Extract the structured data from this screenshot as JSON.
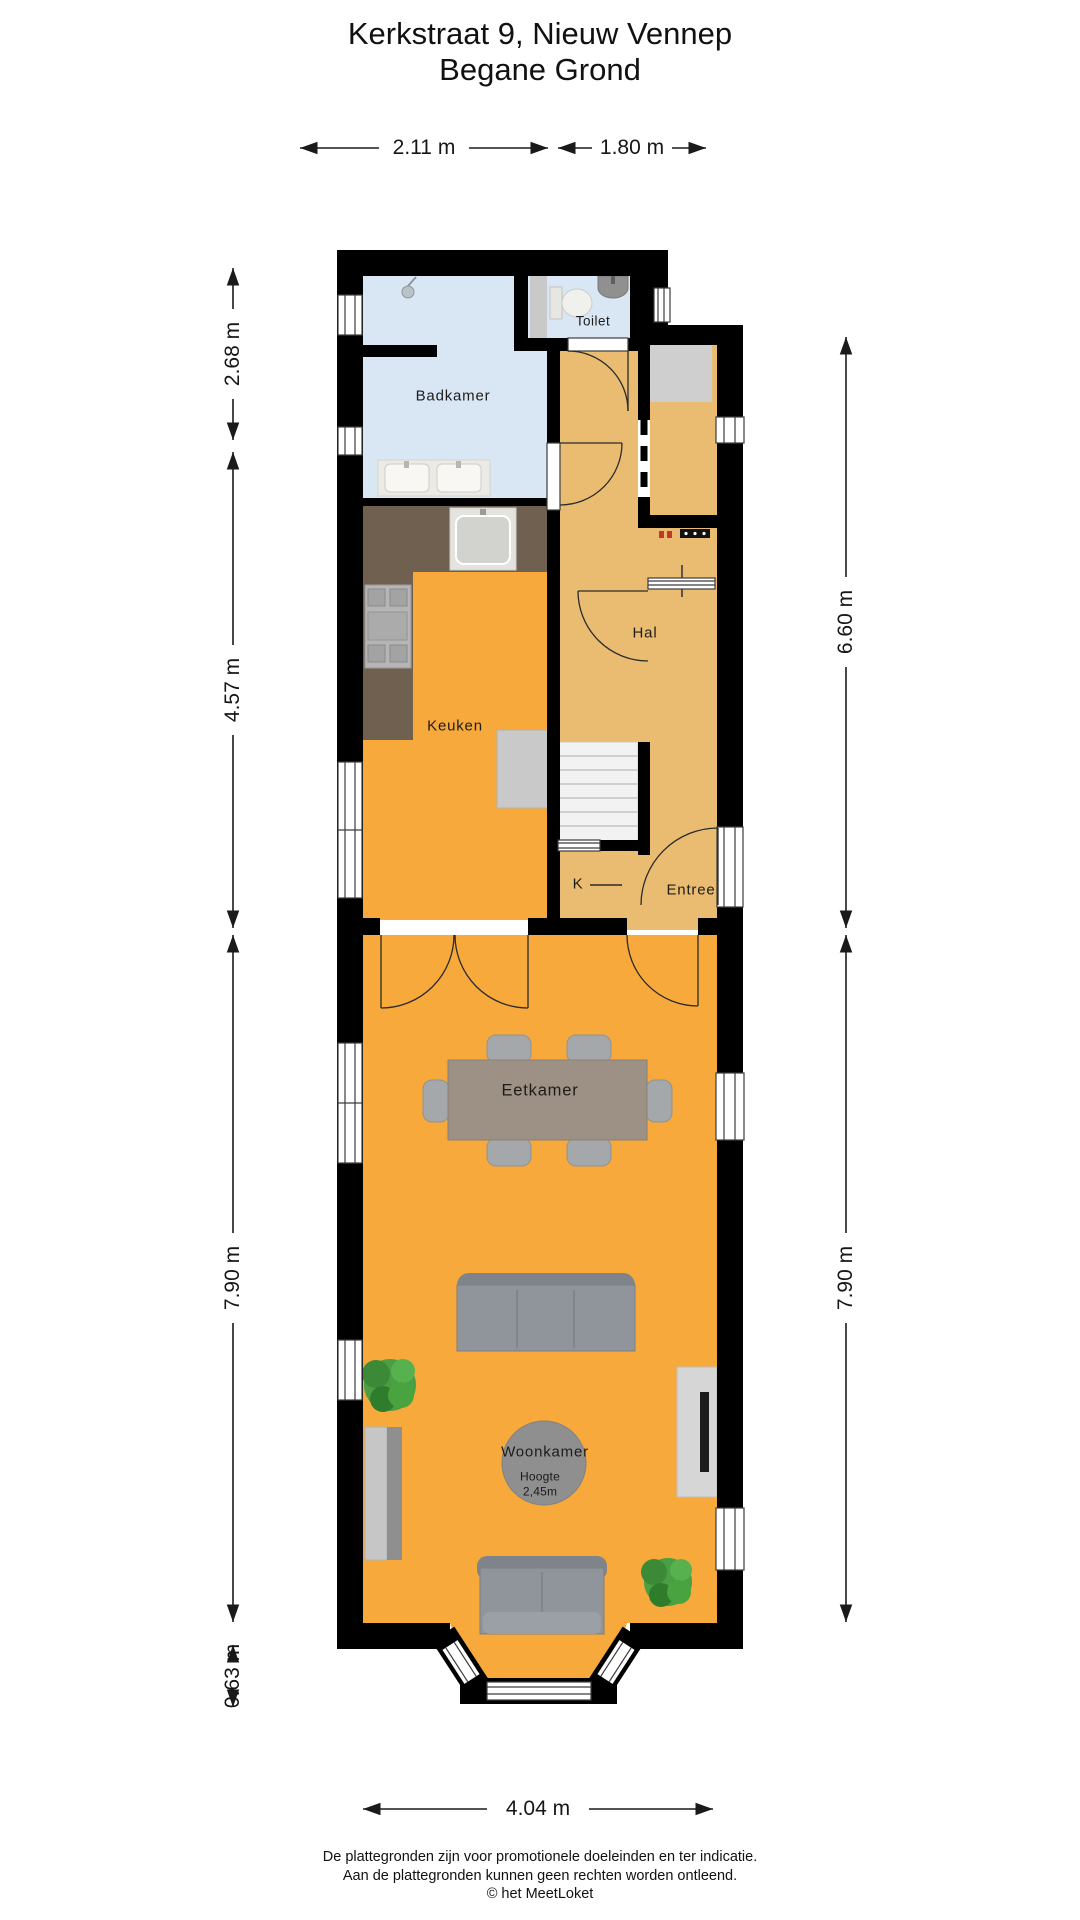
{
  "title": {
    "line1": "Kerkstraat 9, Nieuw Vennep",
    "line2": "Begane Grond"
  },
  "dimensions": {
    "top_left": "2.11 m",
    "top_right": "1.80 m",
    "left_1": "2.68 m",
    "left_2": "4.57 m",
    "left_3": "7.90 m",
    "left_4": "0.63 m",
    "right_1": "6.60 m",
    "right_2": "7.90 m",
    "bottom": "4.04 m"
  },
  "rooms": {
    "badkamer": "Badkamer",
    "toilet": "Toilet",
    "hal": "Hal",
    "keuken": "Keuken",
    "closet": "K",
    "entree": "Entree",
    "eetkamer": "Eetkamer",
    "woonkamer": "Woonkamer",
    "height_note_line1": "Hoogte",
    "height_note_line2": "2,45m"
  },
  "footer": {
    "line1": "De plattegronden zijn voor promotionele doeleinden en ter indicatie.",
    "line2": "Aan de plattegronden kunnen geen rechten worden ontleend.",
    "line3": "© het MeetLoket"
  },
  "colors": {
    "wall": "#000000",
    "bathroom_floor": "#d9e7f4",
    "hall_floor": "#e9bc72",
    "living_floor": "#f7a93c",
    "kitchen_counter": "#6f6050",
    "dimension_ink": "#1a1a1a"
  }
}
